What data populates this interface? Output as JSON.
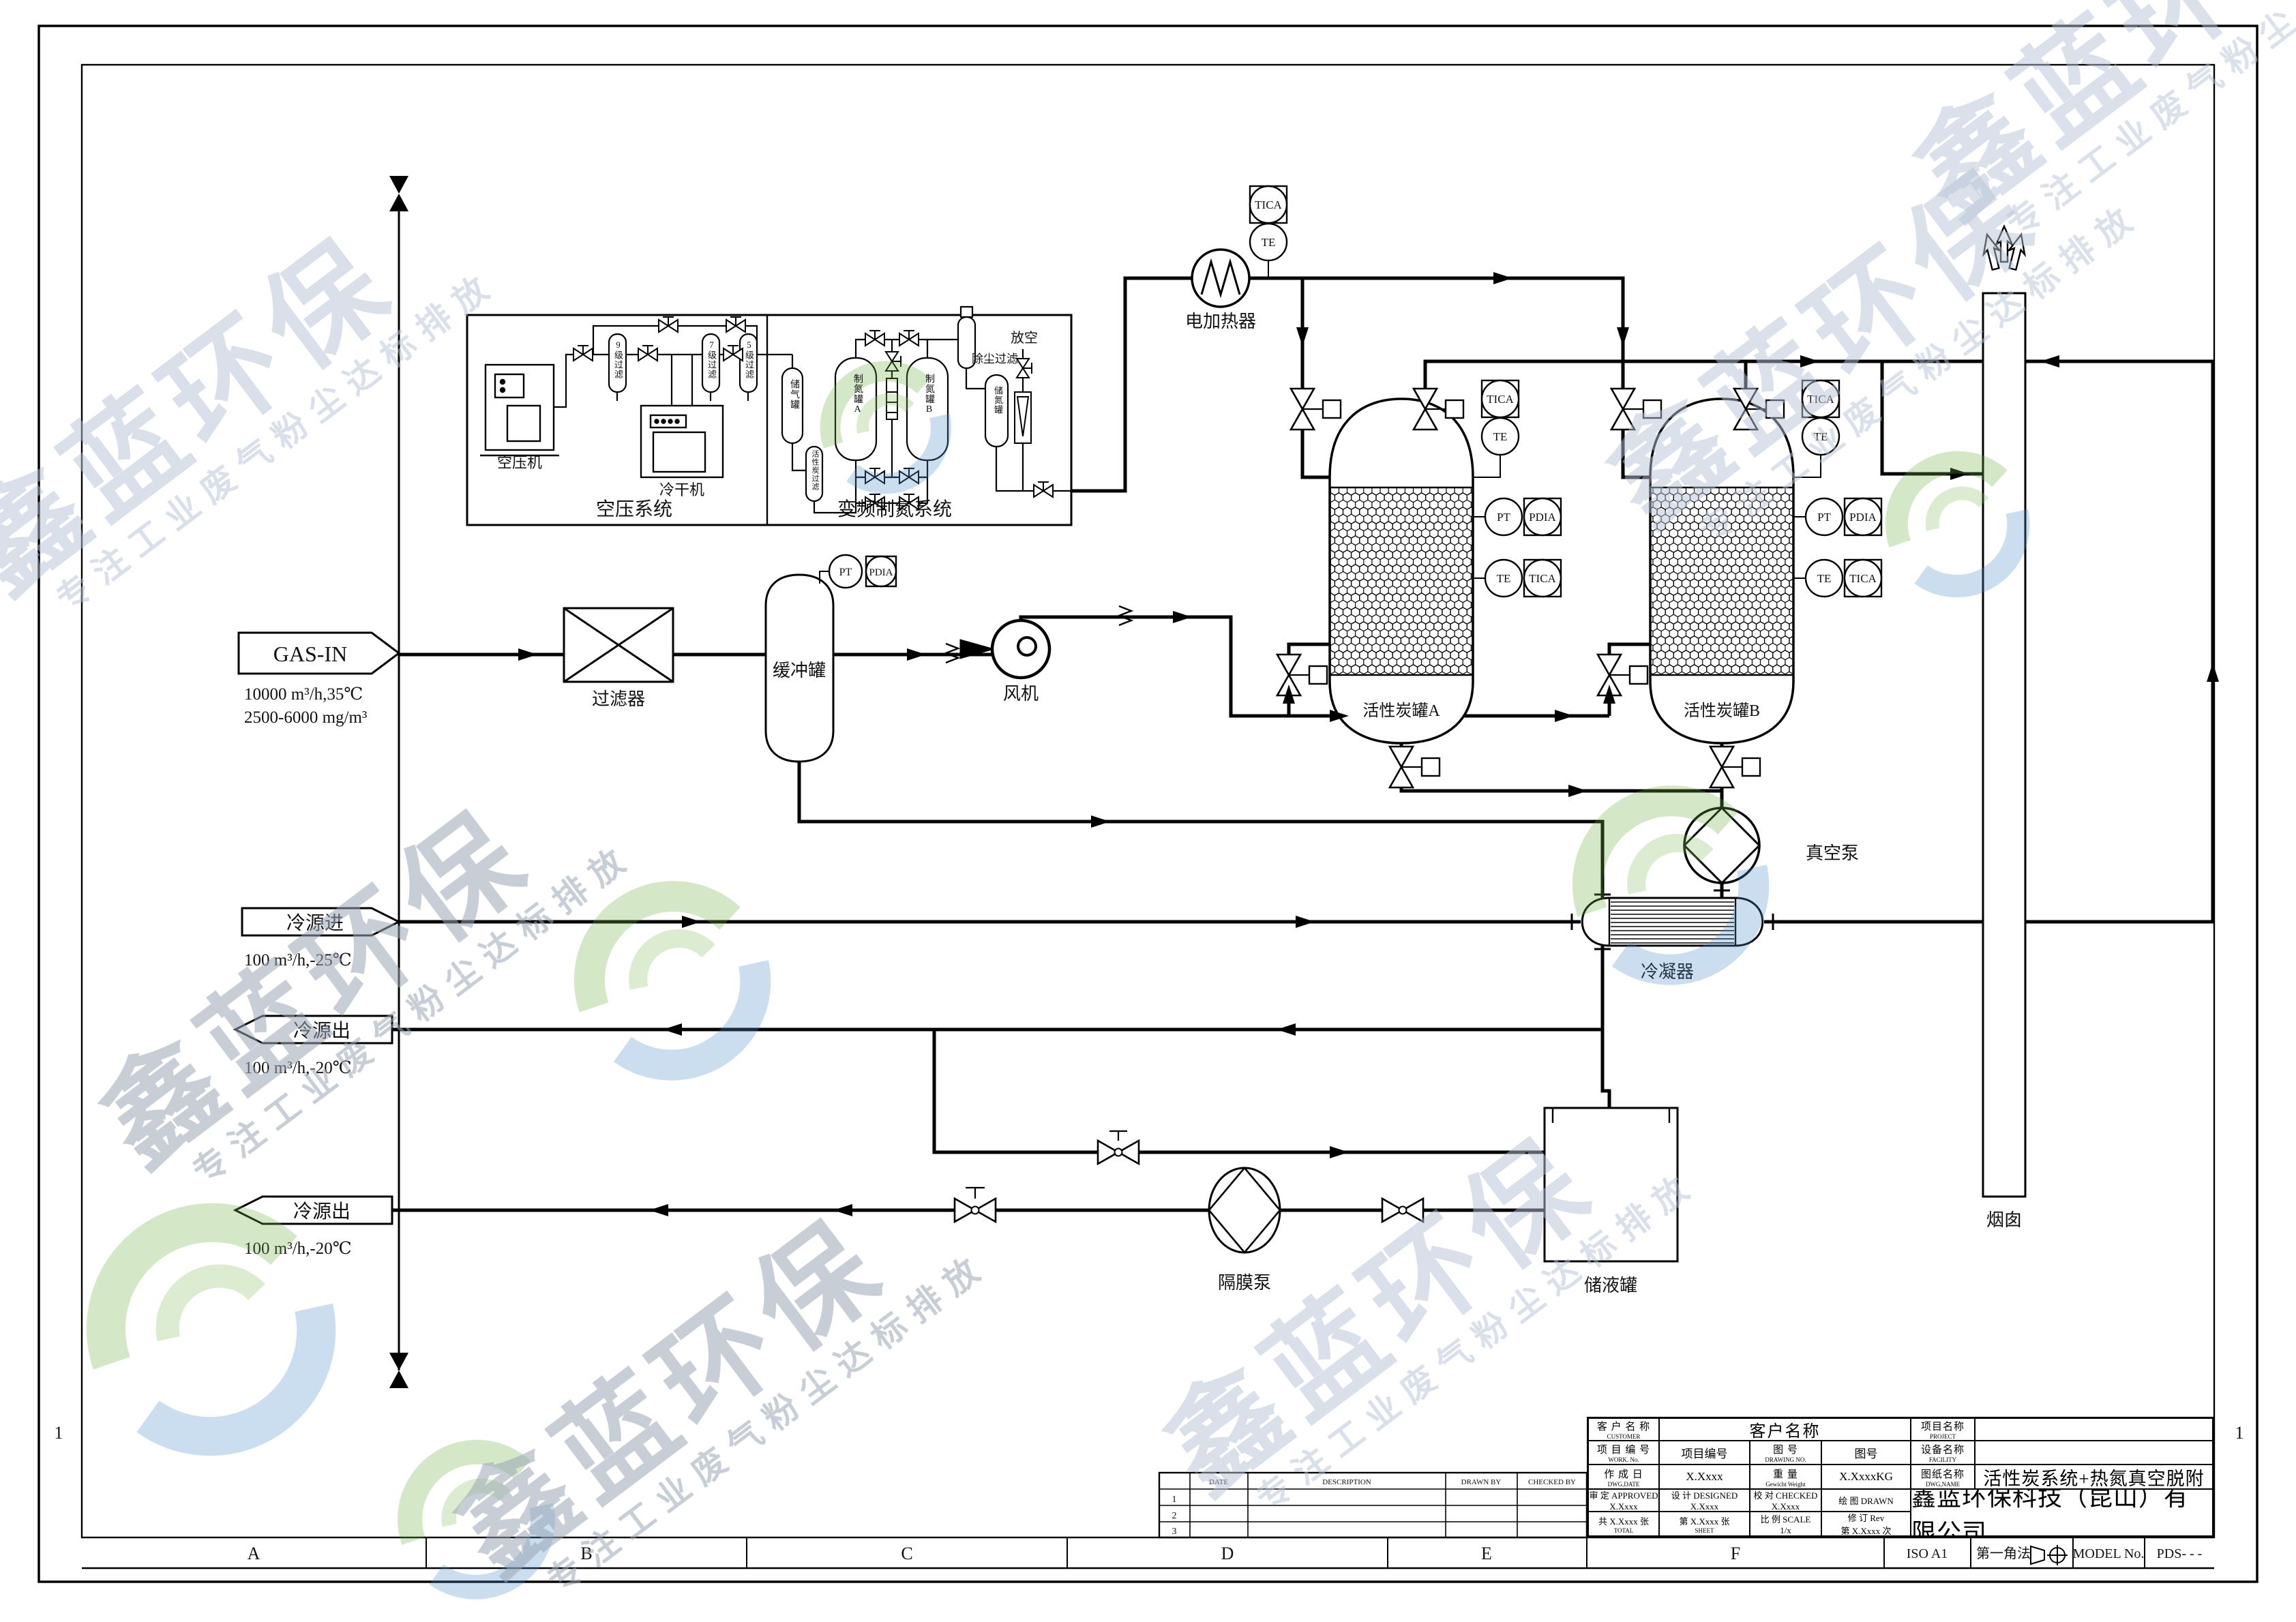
{
  "wm": {
    "brand": "鑫蓝环保",
    "slogan": "专注工业废气粉尘达标排放"
  },
  "streams": {
    "gas_in": {
      "label": "GAS-IN",
      "spec1": "10000 m³/h,35℃",
      "spec2": "2500-6000 mg/m³"
    },
    "cold_in": {
      "label": "冷源进",
      "spec": "100 m³/h,-25℃"
    },
    "cold_out1": {
      "label": "冷源出",
      "spec": "100 m³/h,-20℃"
    },
    "cold_out2": {
      "label": "冷源出",
      "spec": "100 m³/h,-20℃"
    }
  },
  "eq": {
    "filter": "过滤器",
    "buffer": "缓冲罐",
    "fan": "风机",
    "heater": "电加热器",
    "tank_a": "活性炭罐A",
    "tank_b": "活性炭罐B",
    "vpump": "真空泵",
    "cond": "冷凝器",
    "ltank": "储液罐",
    "dpump": "隔膜泵",
    "stack": "烟囱"
  },
  "air": {
    "sys": "空压系统",
    "n2sys": "变频制氮系统",
    "comp": "空压机",
    "dryer": "冷干机",
    "f9": "9级过滤",
    "f7": "7级过滤",
    "f5": "5级过滤",
    "atank": "储气罐",
    "n2a": "制氮罐A",
    "n2b": "制氮罐B",
    "cfil": "活性炭过滤",
    "dfil": "除尘过滤",
    "ntank": "储氮罐",
    "vent": "放空"
  },
  "ins": {
    "tica": "TICA",
    "te": "TE",
    "pt": "PT",
    "pdia": "PDIA"
  },
  "grid": {
    "a": "A",
    "b": "B",
    "c": "C",
    "d": "D",
    "e": "E",
    "f": "F",
    "row": "1"
  },
  "fi": {
    "iso": "ISO A1",
    "proj": "第一角法",
    "model": "MODEL No.",
    "pds": "PDS-  -  -"
  },
  "rev": {
    "h1": "DATE",
    "h2": "DESCRIPTION",
    "h3": "DRAWN BY",
    "h4": "CHECKED BY",
    "r1": "1",
    "r2": "2",
    "r3": "3"
  },
  "tb": {
    "customer_l1": "客 户 名 称",
    "customer_l2": "CUSTOMER",
    "customer_v": "客户名称",
    "project_l1": "项目名称",
    "project_l2": "PROJECT",
    "work_l1": "项 目 编 号",
    "work_l2": "WORK. No.",
    "work_v": "项目编号",
    "dwgno_l1": "图 号",
    "dwgno_l2": "DRAWING NO.",
    "dwgno_v": "图号",
    "facility_l1": "设备名称",
    "facility_l2": "FACILITY",
    "date_l1": "作 成 日",
    "date_l2": "DWG,DATE",
    "date_v": "X.Xxxx",
    "weight_l1": "重 量",
    "weight_l2": "Gewicht Weight",
    "weight_v": "X.XxxxKG",
    "dwgname_l1": "图纸名称",
    "dwgname_l2": "DWG,NAME",
    "dwgname_v": "活性炭系统+热氮真空脱附",
    "approved_l": "审 定 APPROVED",
    "approved_v": "X.Xxxx",
    "designed_l": "设 计 DESIGNED",
    "designed_v": "X.Xxxx",
    "checked_l": "校 对 CHECKED",
    "checked_v": "X.Xxxx",
    "drawn_l": "绘 图 DRAWN",
    "company": "鑫蓝环保科技（昆山）有限公司",
    "total_l": "共 X.Xxxx 张",
    "total_e": "TOTAL",
    "sheet_l": "第 X.Xxxx 张",
    "sheet_e": "SHEET",
    "scale_l": "比 例 SCALE",
    "scale_v": "1/x",
    "rev_l": "修 订 Rev",
    "rev_v": "第 X.Xxxx 次"
  }
}
